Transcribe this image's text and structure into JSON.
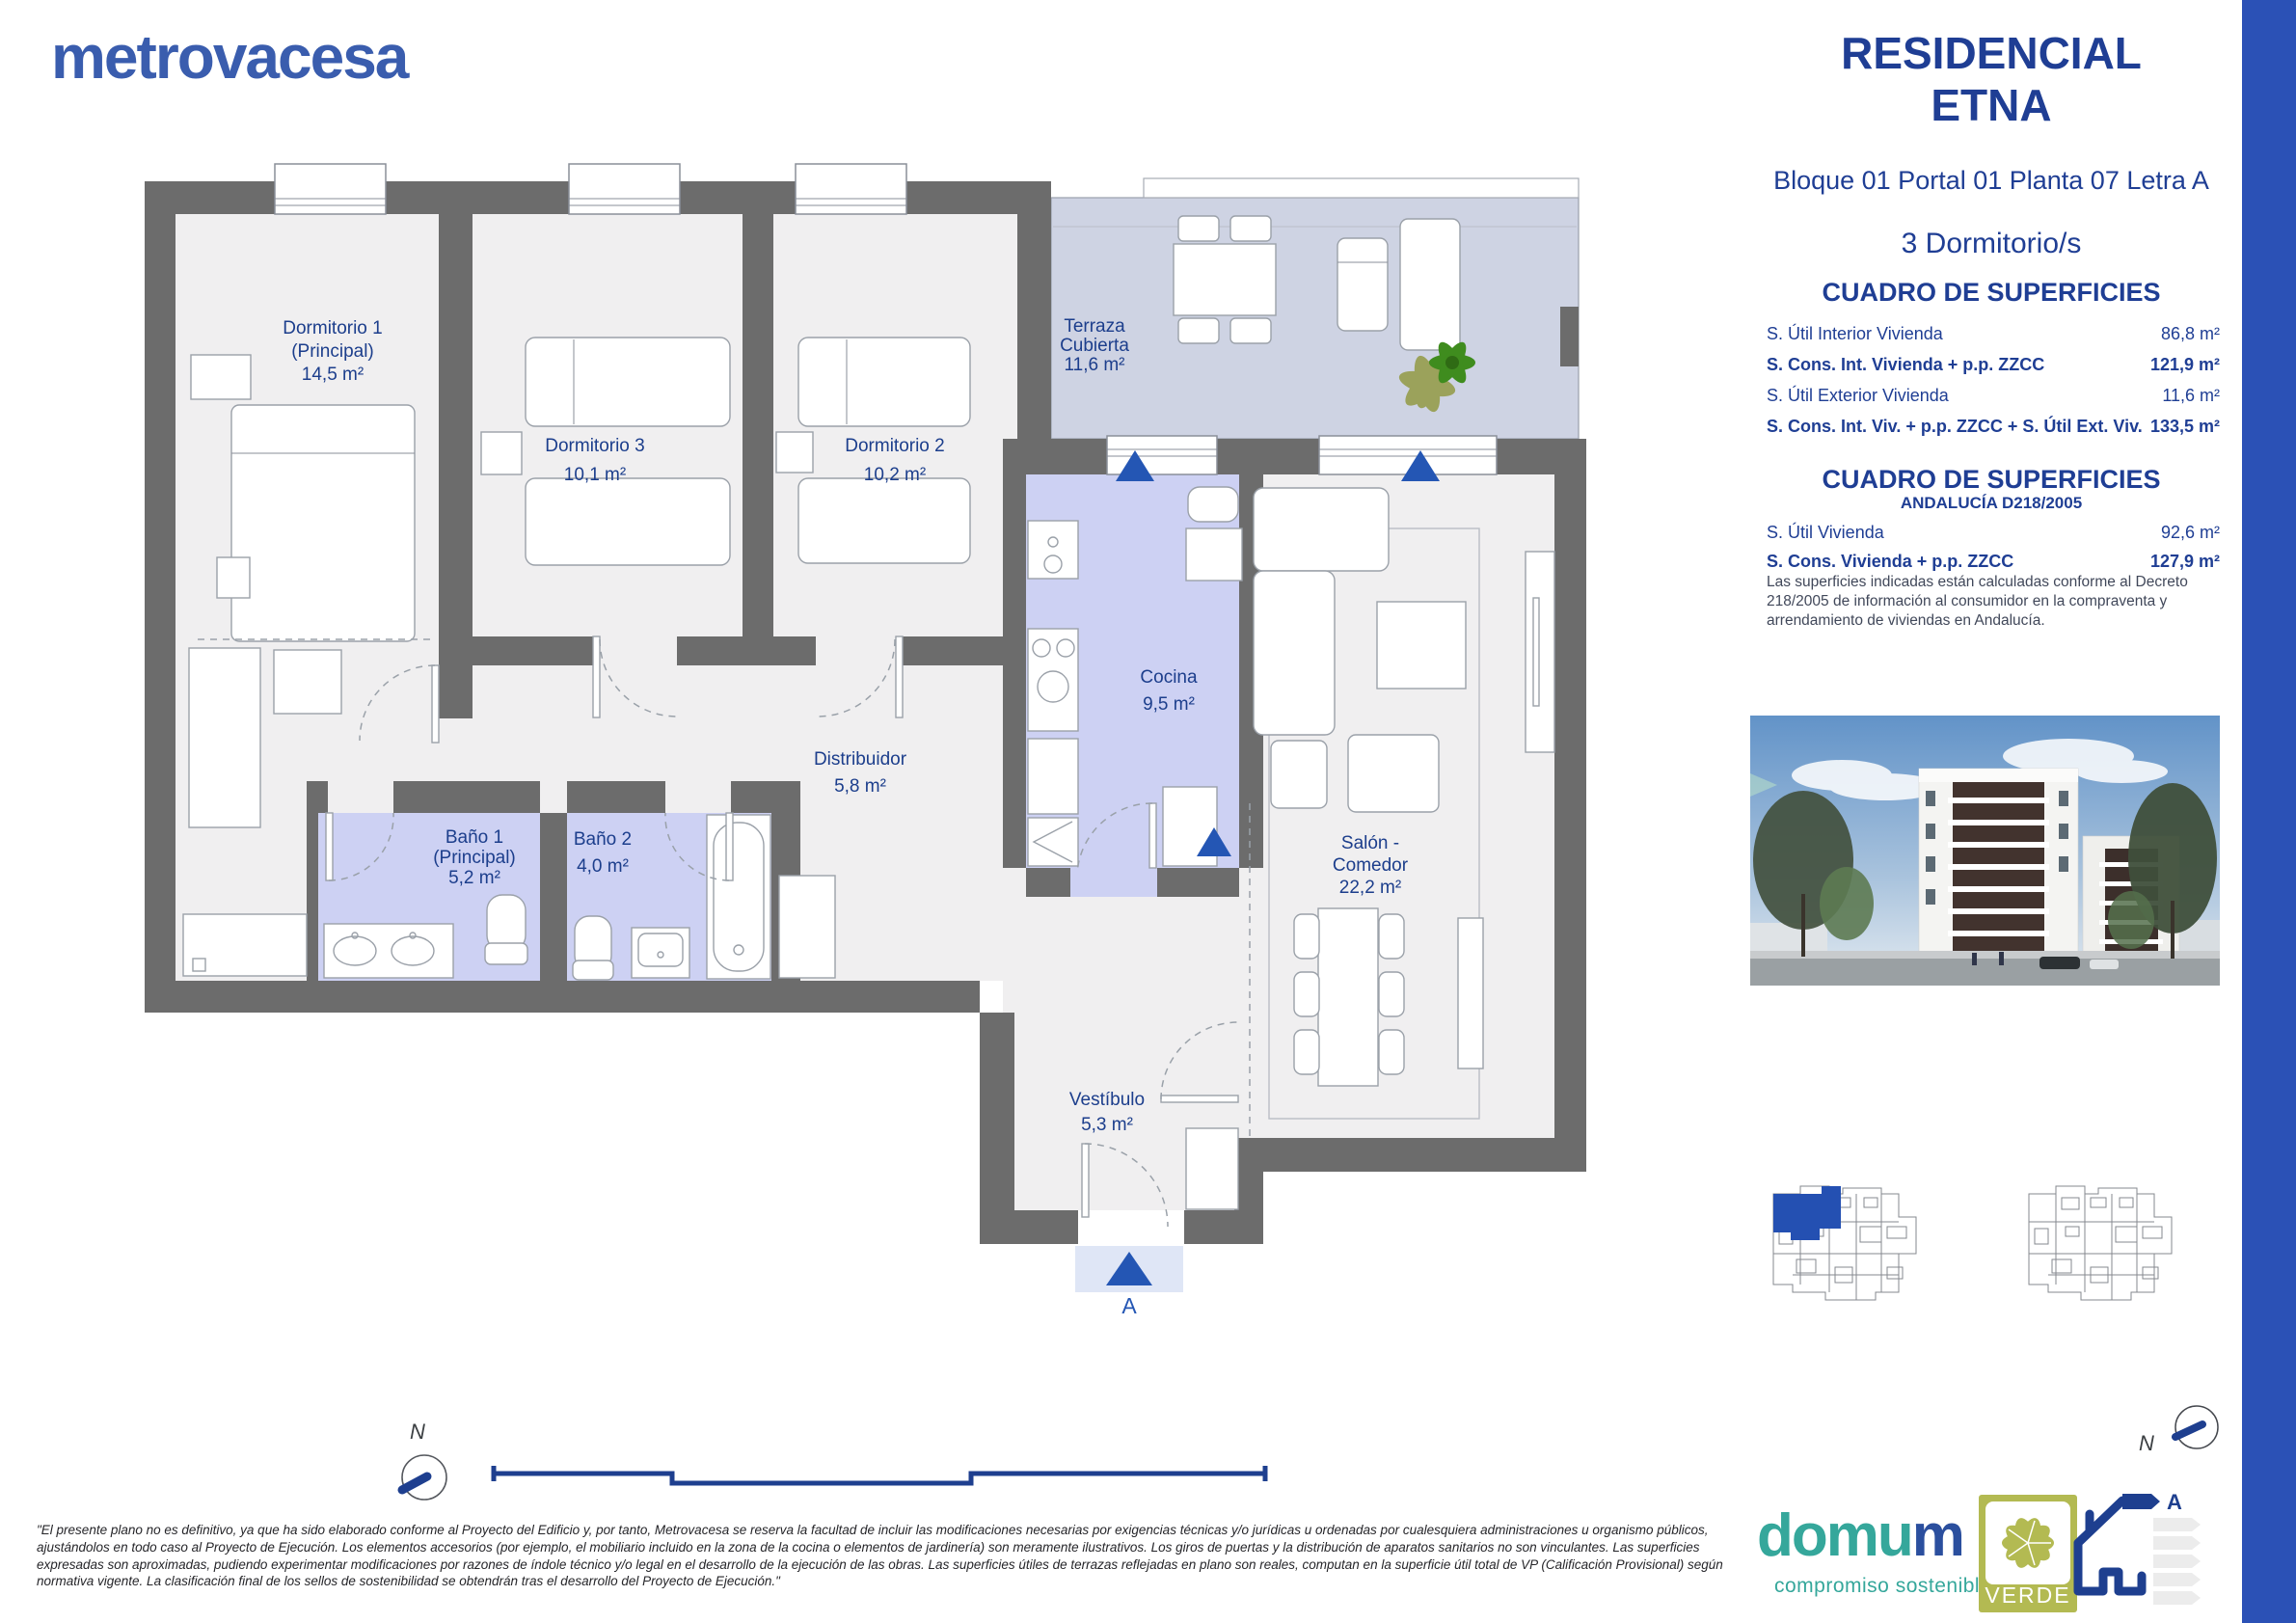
{
  "brand": {
    "name": "metrovacesa",
    "color": "#3a5dae"
  },
  "header": {
    "title_line1": "RESIDENCIAL",
    "title_line2": "ETNA",
    "location": "Bloque 01 Portal 01 Planta 07 Letra A",
    "bedrooms": "3 Dormitorio/s"
  },
  "surfaces": {
    "title": "CUADRO DE SUPERFICIES",
    "rows": [
      {
        "label": "S. Útil Interior Vivienda",
        "value": "86,8 m²"
      },
      {
        "label": "S. Cons. Int. Vivienda + p.p. ZZCC",
        "value": "121,9 m²"
      },
      {
        "label": "S. Útil Exterior Vivienda",
        "value": "11,6 m²"
      },
      {
        "label": "S. Cons. Int. Viv. + p.p. ZZCC + S. Útil Ext. Viv.",
        "value": "133,5 m²"
      }
    ]
  },
  "surfaces_andalucia": {
    "title": "CUADRO DE SUPERFICIES",
    "subtitle": "ANDALUCÍA D218/2005",
    "rows": [
      {
        "label": "S. Útil Vivienda",
        "value": "92,6 m²"
      },
      {
        "label": "S. Cons. Vivienda + p.p. ZZCC",
        "value": "127,9 m²"
      }
    ],
    "note": "Las superficies indicadas están calculadas conforme al Decreto 218/2005 de información al consumidor en la compraventa y arrendamiento de viviendas en Andalucía."
  },
  "floorplan": {
    "rooms": {
      "dorm1": {
        "l1": "Dormitorio 1",
        "l2": "(Principal)",
        "l3": "14,5 m²"
      },
      "dorm3": {
        "l1": "Dormitorio 3",
        "l2": "10,1 m²"
      },
      "dorm2": {
        "l1": "Dormitorio 2",
        "l2": "10,2 m²"
      },
      "terraza": {
        "l1": "Terraza",
        "l2": "Cubierta",
        "l3": "11,6 m²"
      },
      "cocina": {
        "l1": "Cocina",
        "l2": "9,5 m²"
      },
      "distribuidor": {
        "l1": "Distribuidor",
        "l2": "5,8 m²"
      },
      "bano1": {
        "l1": "Baño 1",
        "l2": "(Principal)",
        "l3": "5,2 m²"
      },
      "bano2": {
        "l1": "Baño 2",
        "l2": "4,0 m²"
      },
      "salon": {
        "l1": "Salón -",
        "l2": "Comedor",
        "l3": "22,2 m²"
      },
      "vestibulo": {
        "l1": "Vestíbulo",
        "l2": "5,3 m²"
      }
    },
    "section_label": "A",
    "north_label": "N",
    "colors": {
      "wall": "#6c6c6c",
      "floor": "#f0eff0",
      "wet_floor": "#cdd1f3",
      "terrace_floor": "#ced3e3",
      "marker_blue": "#2456b4"
    }
  },
  "footer": {
    "disclaimer": "\"El presente plano no es definitivo, ya que ha sido elaborado conforme al Proyecto del Edificio y, por tanto, Metrovacesa se reserva la facultad de incluir las modificaciones necesarias por exigencias técnicas y/o jurídicas u ordenadas por cualesquiera administraciones u organismo públicos, ajustándolos en todo caso al Proyecto de Ejecución. Los elementos accesorios (por ejemplo, el mobiliario incluido en la zona de la cocina o elementos de jardinería) son meramente ilustrativos. Los giros de puertas y la distribución de aparatos sanitarios no son vinculantes. Las superficies expresadas son aproximadas, pudiendo experimentar modificaciones por razones de índole técnico y/o legal en el desarrollo de la ejecución de las obras. Las superficies útiles de terrazas reflejadas en plano son reales, computan en la superficie útil total de VP (Calificación Provisional) según normativa vigente. La clasificación final de los sellos de sostenibilidad se obtendrán tras el desarrollo del Proyecto de Ejecución.\""
  },
  "branding": {
    "domum_part1": "domu",
    "domum_part2": "m",
    "domum_tagline": "compromiso sostenible",
    "verde_label": "VERDE",
    "energy_label": "A",
    "north_label": "N"
  }
}
